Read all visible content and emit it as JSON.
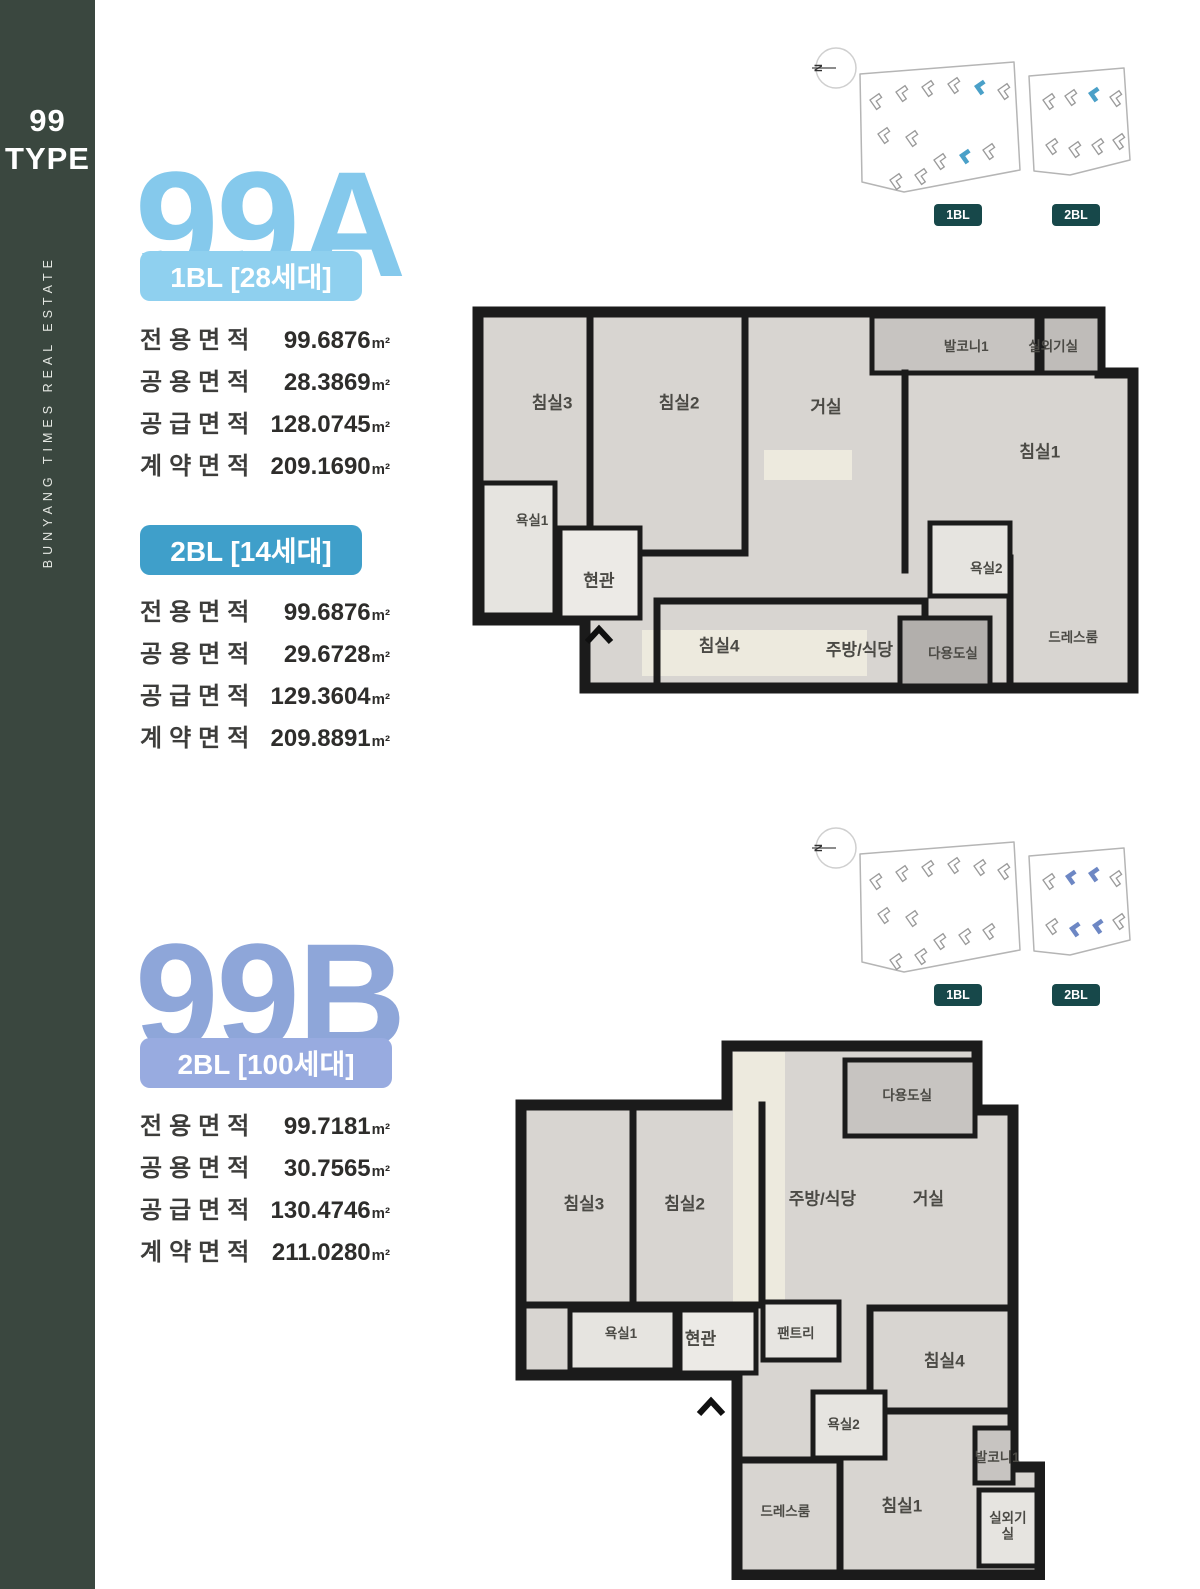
{
  "colors": {
    "sidebar_bg": "#3a473f",
    "title_a": "#85c9ec",
    "title_b": "#8ea6d9",
    "badge_1bl_a": "#8fd0ef",
    "badge_2bl_a": "#3f9fca",
    "badge_2bl_b": "#98abe0",
    "map_badge": "#17484a",
    "wall": "#1b1b1b",
    "floor": "#d8d5d1"
  },
  "sidebar": {
    "type_number": "99",
    "type_word": "TYPE",
    "vertical_text": "BUNYANG TIMES REAL ESTATE"
  },
  "unit": "m²",
  "compass_letter": "N",
  "sections": [
    {
      "title": "99A",
      "sitemap": {
        "block_labels": [
          "1BL",
          "2BL"
        ],
        "highlight_color": "#4aa0c8",
        "buildings": [
          [
            62,
            58,
            0
          ],
          [
            88,
            50,
            0
          ],
          [
            114,
            45,
            0
          ],
          [
            140,
            42,
            0
          ],
          [
            166,
            44,
            1
          ],
          [
            190,
            48,
            0
          ],
          [
            70,
            92,
            0
          ],
          [
            98,
            95,
            0
          ],
          [
            126,
            118,
            0
          ],
          [
            151,
            113,
            1
          ],
          [
            175,
            108,
            0
          ],
          [
            82,
            138,
            0
          ],
          [
            107,
            133,
            0
          ],
          [
            235,
            58,
            0
          ],
          [
            257,
            54,
            0
          ],
          [
            280,
            51,
            1
          ],
          [
            302,
            55,
            0
          ],
          [
            238,
            103,
            0
          ],
          [
            261,
            106,
            0
          ],
          [
            284,
            103,
            0
          ],
          [
            305,
            98,
            0
          ]
        ]
      },
      "blocks": [
        {
          "badge": "1BL [28세대]",
          "rows": [
            [
              "전용면적",
              "99.6876"
            ],
            [
              "공용면적",
              "28.3869"
            ],
            [
              "공급면적",
              "128.0745"
            ],
            [
              "계약면적",
              "209.1690"
            ]
          ]
        },
        {
          "badge": "2BL [14세대]",
          "rows": [
            [
              "전용면적",
              "99.6876"
            ],
            [
              "공용면적",
              "29.6728"
            ],
            [
              "공급면적",
              "129.3604"
            ],
            [
              "계약면적",
              "209.8891"
            ]
          ]
        }
      ],
      "plan": {
        "rooms": [
          {
            "label": "침실3",
            "x": 12,
            "y": 25
          },
          {
            "label": "침실2",
            "x": 31,
            "y": 25
          },
          {
            "label": "거실",
            "x": 53,
            "y": 26
          },
          {
            "label": "발코니1",
            "x": 74,
            "y": 11,
            "small": true
          },
          {
            "label": "실외기실",
            "x": 87,
            "y": 11,
            "small": true
          },
          {
            "label": "침실1",
            "x": 85,
            "y": 37
          },
          {
            "label": "욕실1",
            "x": 9,
            "y": 54,
            "small": true
          },
          {
            "label": "현관",
            "x": 19,
            "y": 69
          },
          {
            "label": "침실4",
            "x": 37,
            "y": 85
          },
          {
            "label": "주방/식당",
            "x": 58,
            "y": 86
          },
          {
            "label": "다용도실",
            "x": 72,
            "y": 87,
            "small": true
          },
          {
            "label": "욕실2",
            "x": 77,
            "y": 66,
            "small": true
          },
          {
            "label": "드레스룸",
            "x": 90,
            "y": 83,
            "small": true
          }
        ]
      }
    },
    {
      "title": "99B",
      "sitemap": {
        "block_labels": [
          "1BL",
          "2BL"
        ],
        "highlight_color": "#6d87c4",
        "buildings": [
          [
            62,
            58,
            0
          ],
          [
            88,
            50,
            0
          ],
          [
            114,
            45,
            0
          ],
          [
            140,
            42,
            0
          ],
          [
            166,
            44,
            0
          ],
          [
            190,
            48,
            0
          ],
          [
            70,
            92,
            0
          ],
          [
            98,
            95,
            0
          ],
          [
            126,
            118,
            0
          ],
          [
            151,
            113,
            0
          ],
          [
            175,
            108,
            0
          ],
          [
            82,
            138,
            0
          ],
          [
            107,
            133,
            0
          ],
          [
            235,
            58,
            0
          ],
          [
            257,
            54,
            1
          ],
          [
            280,
            51,
            1
          ],
          [
            302,
            55,
            0
          ],
          [
            238,
            103,
            0
          ],
          [
            261,
            106,
            1
          ],
          [
            284,
            103,
            1
          ],
          [
            305,
            98,
            0
          ]
        ]
      },
      "blocks": [
        {
          "badge": "2BL [100세대]",
          "rows": [
            [
              "전용면적",
              "99.7181"
            ],
            [
              "공용면적",
              "30.7565"
            ],
            [
              "공급면적",
              "130.4746"
            ],
            [
              "계약면적",
              "211.0280"
            ]
          ]
        }
      ],
      "plan": {
        "rooms": [
          {
            "label": "침실3",
            "x": 13,
            "y": 30
          },
          {
            "label": "침실2",
            "x": 32,
            "y": 30
          },
          {
            "label": "주방/식당",
            "x": 58,
            "y": 29
          },
          {
            "label": "거실",
            "x": 78,
            "y": 29
          },
          {
            "label": "다용도실",
            "x": 74,
            "y": 10,
            "small": true
          },
          {
            "label": "욕실1",
            "x": 20,
            "y": 54,
            "small": true
          },
          {
            "label": "현관",
            "x": 35,
            "y": 55
          },
          {
            "label": "팬트리",
            "x": 53,
            "y": 54,
            "small": true
          },
          {
            "label": "욕실2",
            "x": 62,
            "y": 71,
            "small": true
          },
          {
            "label": "드레스룸",
            "x": 51,
            "y": 87,
            "small": true
          },
          {
            "label": "침실1",
            "x": 73,
            "y": 86
          },
          {
            "label": "침실4",
            "x": 81,
            "y": 59
          },
          {
            "label": "발코니1",
            "x": 91,
            "y": 77,
            "small": true
          },
          {
            "label": "실외기실",
            "x": 93,
            "y": 90,
            "small": true,
            "wrap": true
          }
        ]
      }
    }
  ]
}
